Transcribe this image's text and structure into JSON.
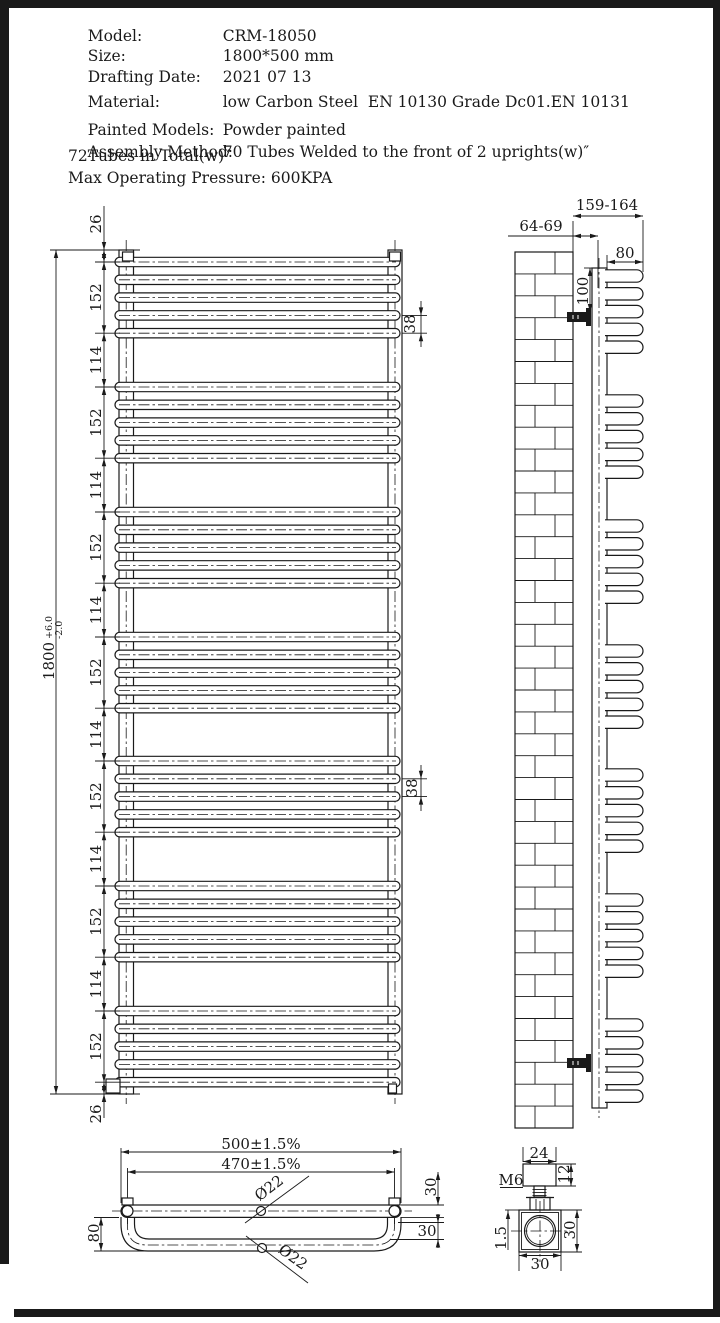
{
  "spec_table": {
    "rows": [
      {
        "label": "Model:",
        "value": "CRM-18050"
      },
      {
        "label": "Size:",
        "value": "1800*500 mm"
      },
      {
        "label": "Drafting Date:",
        "value": "2021 07 13"
      },
      {
        "label": "Material:",
        "value": "low Carbon Steel  EN 10130 Grade Dc01.EN 10131"
      },
      {
        "label": "Painted Models:",
        "value": "Powder painted"
      },
      {
        "label": "Assembly Method:",
        "value": "70 Tubes Welded to the front of 2 uprights(w)″"
      }
    ],
    "notes": [
      "72Tubes in Total(w)″",
      "Max Operating Pressure: 600KPA"
    ]
  },
  "front_view": {
    "tube_groups": 7,
    "tubes_per_group": 5,
    "chain_dims": [
      "26",
      "152",
      "114",
      "152",
      "114",
      "152",
      "114",
      "152",
      "114",
      "152",
      "114",
      "152",
      "114",
      "152",
      "26"
    ],
    "overall_dim": {
      "value": "1800",
      "tol_plus": "+6.0",
      "tol_minus": "-2.0"
    },
    "tube_pitch_dim_top": "38",
    "tube_pitch_dim_mid": "38"
  },
  "side_view": {
    "overall_depth": "159-164",
    "wall_to_tube_centre": "64-69",
    "loop_depth": "80",
    "bracket_offset": "100"
  },
  "plan_view": {
    "overall_width": "500±1.5%",
    "hole_centres": "470±1.5%",
    "loop_depth": "80",
    "rear_tube_dia": "Ø22",
    "front_tube_dia": "Ø22",
    "offset_a": "30",
    "offset_b": "30"
  },
  "bracket_detail": {
    "cap_width": "24",
    "cap_depth": "12",
    "thread": "M6",
    "wall_thickness": "1.5",
    "body_height": "30",
    "body_width": "30"
  },
  "colors": {
    "line": "#1a1a1a",
    "paper": "#ffffff"
  }
}
